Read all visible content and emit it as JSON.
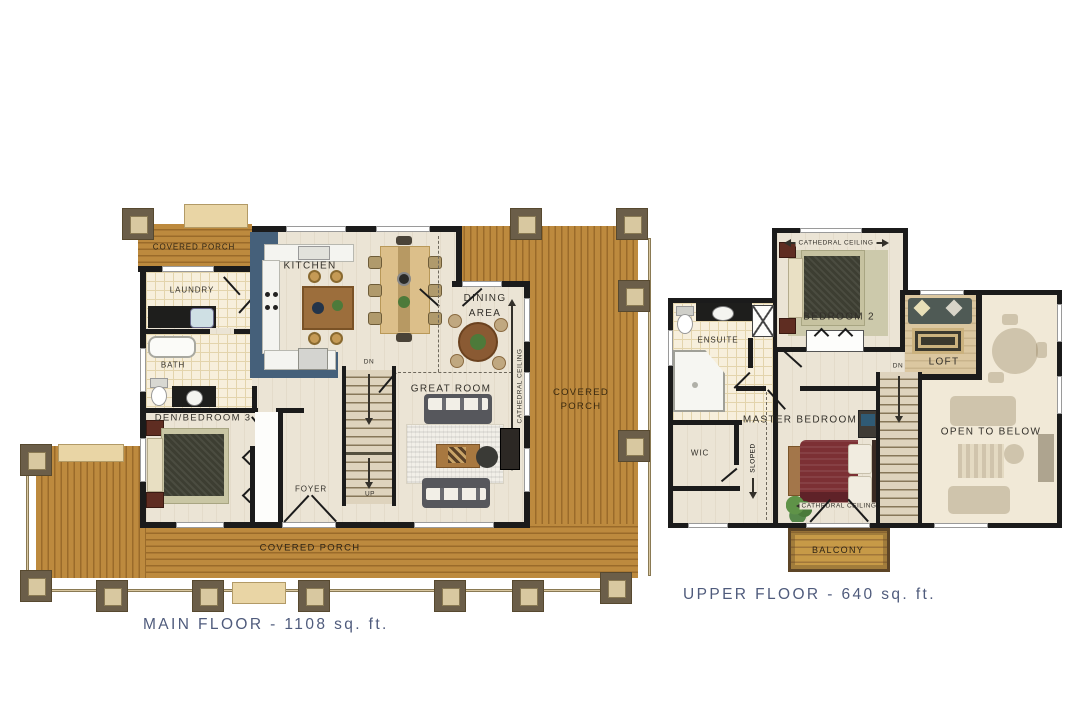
{
  "main_floor": {
    "title": "MAIN FLOOR - 1108 sq. ft.",
    "labels": {
      "covered_porch_top": "COVERED PORCH",
      "laundry": "LAUNDRY",
      "bath": "BATH",
      "den": "DEN/BEDROOM 3",
      "foyer": "FOYER",
      "kitchen": "KITCHEN",
      "dining_area": "DINING AREA",
      "great_room": "GREAT ROOM",
      "covered_porch_right": "COVERED PORCH",
      "covered_porch_bottom": "COVERED PORCH",
      "cathedral_ceiling": "CATHEDRAL CEILING",
      "up": "UP",
      "dn": "DN"
    }
  },
  "upper_floor": {
    "title": "UPPER FLOOR - 640 sq. ft.",
    "labels": {
      "bedroom2": "BEDROOM 2",
      "cathedral_ceiling_bedroom2": "CATHEDRAL CEILING",
      "ensuite": "ENSUITE",
      "wic": "WIC",
      "master_bedroom": "MASTER BEDROOM",
      "sloped": "SLOPED",
      "cathedral_ceiling_master": "CATHEDRAL CEILING",
      "loft": "LOFT",
      "open_to_below": "OPEN TO BELOW",
      "balcony": "BALCONY",
      "dn": "DN"
    }
  },
  "colors": {
    "porch_wood": "#b5813a",
    "wall": "#1b1b1b",
    "kitchen_accent": "#45607a",
    "title_text": "#4f5b7c",
    "label_text": "#33302a"
  }
}
